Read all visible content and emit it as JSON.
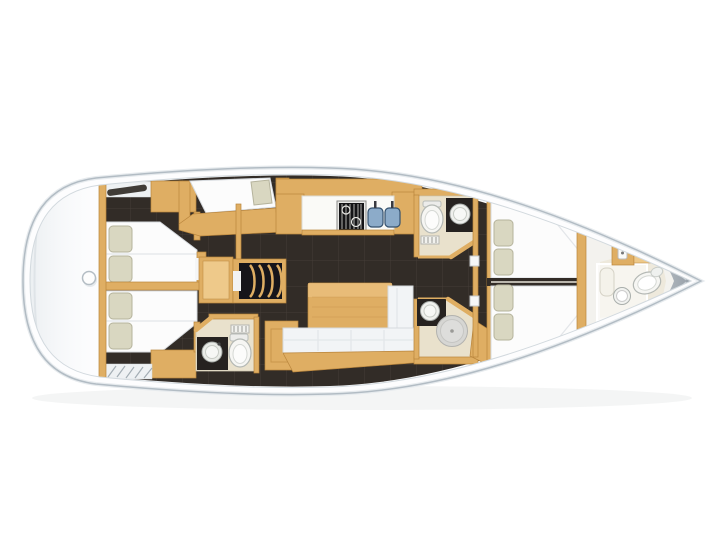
{
  "image": {
    "type": "yacht-interior-floorplan",
    "description": "Sailing yacht interior layout plan, top view, bow pointing right",
    "orientation": "bow-right",
    "visible_text": ""
  },
  "colors": {
    "background": "#ffffff",
    "hull_fill": "#fdfdfe",
    "hull_stroke": "#b2bcc4",
    "hull_stroke_outer": "#e7ebee",
    "deck_line": "#d2d9de",
    "deck_light": "#eef1f3",
    "gray_deck_line": "#aab3ba",
    "wood": "#dfae63",
    "wood_dark": "#b9853c",
    "wood_light": "#eec98a",
    "floor_dark": "#322c27",
    "tile_seam": "#5a534b",
    "mattress": "#fcfcfc",
    "mattress_stroke": "#d6dade",
    "pillow": "#d9d7c1",
    "pillow_stroke": "#b5b39c",
    "bath_floor": "#e9e1cc",
    "fixture_white": "#f6f6f3",
    "fixture_stroke": "#b4b8b4",
    "counter_dark": "#262220",
    "sink_blue": "#8cabc9",
    "sink_blue_dark": "#34516e",
    "stove_black": "#141416",
    "steps_black": "#16151a",
    "shower_gray": "#d6d6d3",
    "sofa_white": "#f2f4f6",
    "bow_wedge_light": "#c6ccd2",
    "bow_wedge_dark": "#8f98a1"
  },
  "layout_semantics": {
    "rooms": [
      {
        "id": "swim-platform",
        "furniture": [
          "stern-winch"
        ]
      },
      {
        "id": "aft-cabin-port",
        "furniture": [
          "double-berth",
          "pillows",
          "wardrobe",
          "deck-hatch"
        ]
      },
      {
        "id": "aft-cabin-starboard",
        "furniture": [
          "double-berth",
          "pillows",
          "wardrobe",
          "transom-steps"
        ]
      },
      {
        "id": "single-berth-nook",
        "furniture": [
          "single-berth",
          "pillow"
        ]
      },
      {
        "id": "companionway",
        "furniture": [
          "nav-desk",
          "stairs"
        ]
      },
      {
        "id": "galley",
        "furniture": [
          "stove",
          "double-sink",
          "countertop",
          "cabinets"
        ]
      },
      {
        "id": "aft-heads",
        "furniture": [
          "toilet",
          "washbasin",
          "vanity",
          "vent-grille"
        ]
      },
      {
        "id": "saloon",
        "furniture": [
          "dining-table",
          "l-sofa",
          "storage-cabinet"
        ]
      },
      {
        "id": "forward-heads-port",
        "furniture": [
          "toilet",
          "washbasin",
          "vent-grille"
        ]
      },
      {
        "id": "forward-heads-starboard",
        "furniture": [
          "washbasin",
          "shower"
        ]
      },
      {
        "id": "forward-cabin-port",
        "furniture": [
          "berth",
          "pillows"
        ]
      },
      {
        "id": "forward-cabin-starboard",
        "furniture": [
          "berth",
          "pillows"
        ]
      },
      {
        "id": "bow-cabin",
        "furniture": [
          "toilet",
          "washbasin",
          "cabinet",
          "shower-pan",
          "bench"
        ]
      }
    ]
  }
}
